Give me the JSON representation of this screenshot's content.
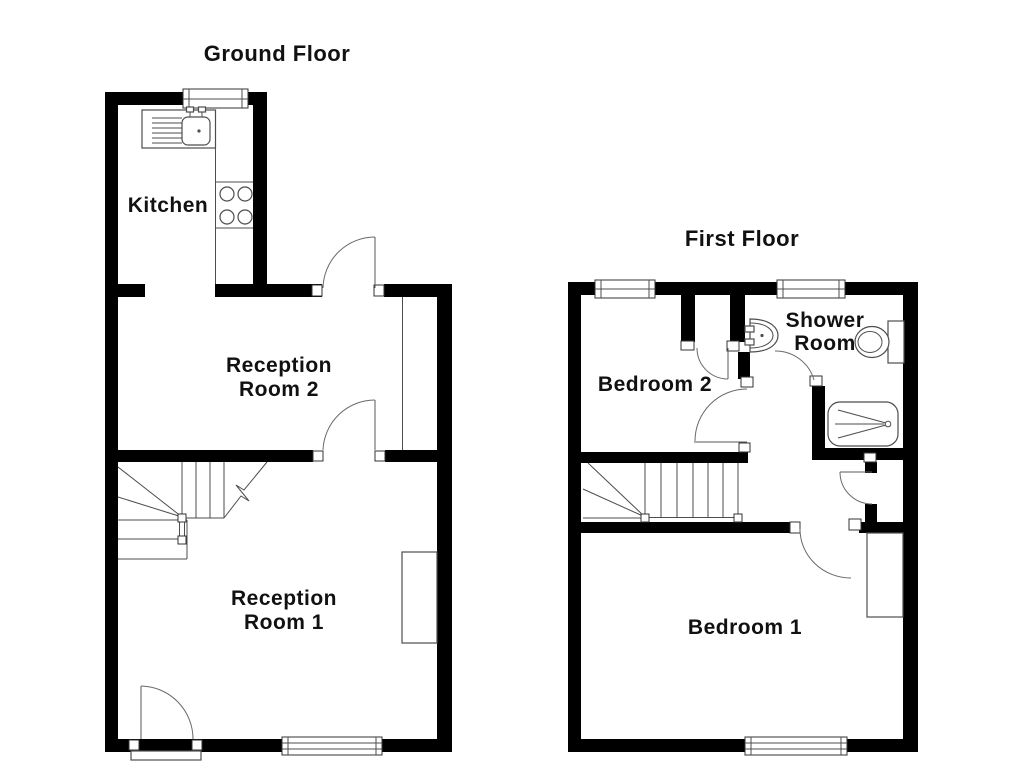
{
  "colors": {
    "background": "#ffffff",
    "wall": "#000000",
    "line": "#4d4d4d"
  },
  "ground_floor": {
    "title": "Ground Floor",
    "rooms": {
      "kitchen": {
        "label": "Kitchen"
      },
      "reception2": {
        "line1": "Reception",
        "line2": "Room 2"
      },
      "reception1": {
        "line1": "Reception",
        "line2": "Room 1"
      }
    },
    "fixtures": [
      "sink-drainer-icon",
      "hob-icon",
      "winder-stairs-icon",
      "front-door-icon",
      "back-door-icon",
      "window-icon",
      "chimney-breast"
    ]
  },
  "first_floor": {
    "title": "First Floor",
    "rooms": {
      "bedroom2": {
        "label": "Bedroom 2"
      },
      "shower": {
        "line1": "Shower",
        "line2": "Room"
      },
      "bedroom1": {
        "label": "Bedroom 1"
      }
    },
    "fixtures": [
      "basin-icon",
      "toilet-icon",
      "bath-icon",
      "stairs-icon",
      "airing-cupboard-icon",
      "built-in-cupboard",
      "window-icon"
    ]
  }
}
